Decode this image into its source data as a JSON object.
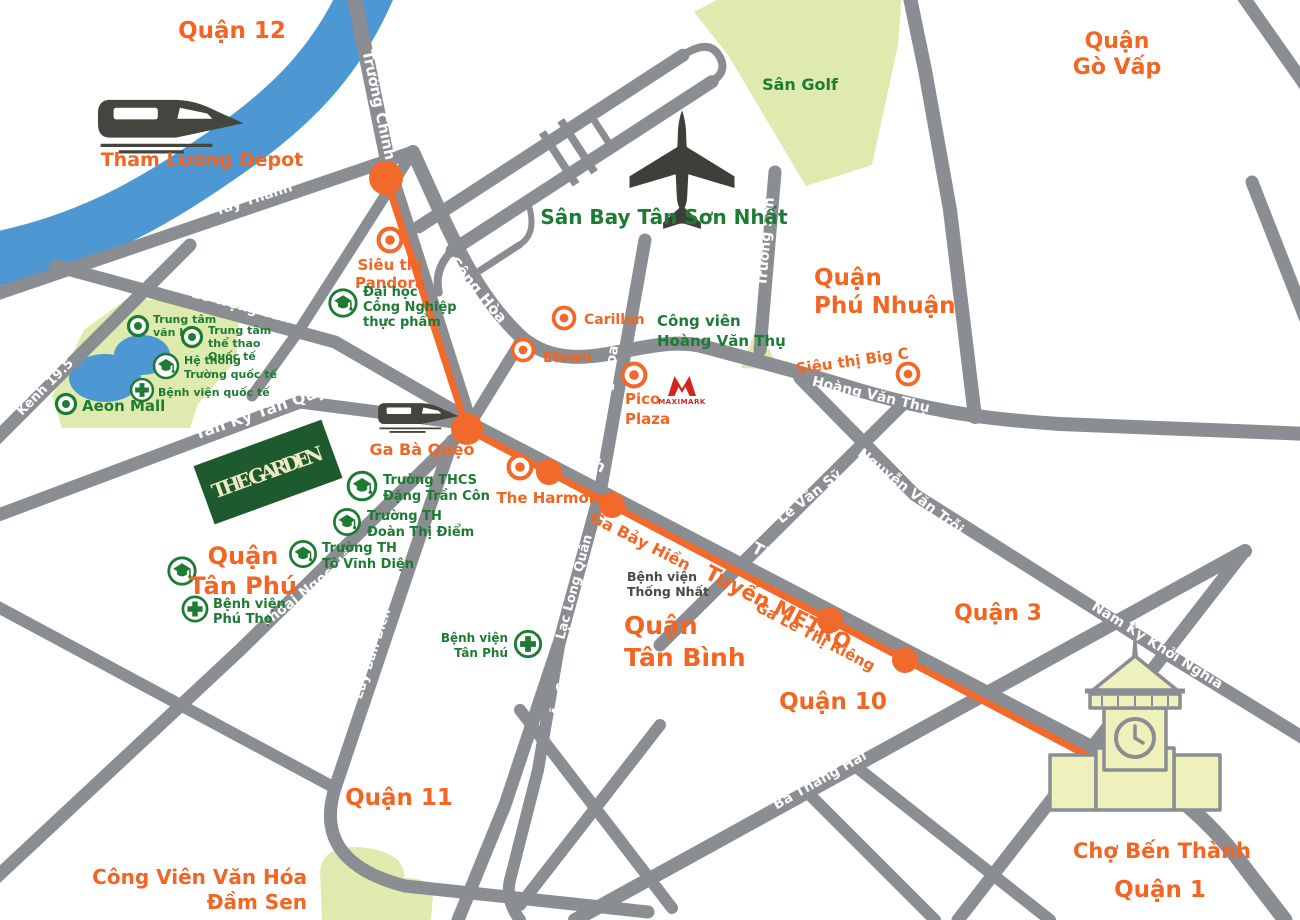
{
  "map": {
    "colors": {
      "road": "#8A8D92",
      "metro_line": "#F2692C",
      "district_text": "#F26522",
      "green_text": "#1E7B34",
      "park_fill": "#DFEAAE",
      "water": "#4D97D3",
      "building_fill": "#EFF1BC",
      "garden_sign": "#1D5B2E",
      "maximark_red": "#D6251D"
    },
    "districts": {
      "q12": "Quận 12",
      "go_vap": [
        "Quận",
        "Gò Vấp"
      ],
      "phu_nhuan": [
        "Quận",
        "Phú Nhuận"
      ],
      "tan_phu": [
        "Quận",
        "Tân Phú"
      ],
      "tan_binh": [
        "Quận",
        "Tân Bình"
      ],
      "q11": "Quận 11",
      "q10": "Quận 10",
      "q3": "Quận 3",
      "q1": "Quận 1"
    },
    "roads": {
      "truong_chinh": "Trường Chinh",
      "tay_thanh": "Tây Thanh",
      "che_lan_vien": "Chế Lan Viên",
      "cong_hoa": "Cộng Hòa",
      "le_trong_tan": "Lê Trọng Tấn",
      "kenh_19_5": "Kênh 19.5",
      "tan_ky_tan_quy": "Tân Kỳ Tân Quý",
      "thoai_ngoc_hau": "Thoại Ngọc Hầu",
      "luy_ban_bich": "Lũy Bán Bích",
      "lac_long_quan": "Lạc Long Quân",
      "au_co": "Âu Cơ",
      "hoang_hoa_tham": "Hoàng Hoa Thám",
      "truong_son": "Trường Sơn",
      "hoang_van_thu": "Hoàng Văn Thụ",
      "nguyen_van_troi": "Nguyễn Văn Trỗi",
      "le_van_sy": "Lê Văn Sỹ",
      "cach_mang_thang_tam": "Cách Mạng Tháng Tám",
      "ba_thang_hai": "Ba Tháng Hai",
      "nam_ky_khoi_nghia": "Nam Kỳ Khởi Nghĩa"
    },
    "water": {
      "kenh_tham_luong": "Kênh Tham Lương"
    },
    "parks": {
      "san_golf": "Sân Golf",
      "cong_vien_hoang_van_thu": [
        "Công viên",
        "Hoàng Văn Thụ"
      ],
      "dam_sen": [
        "Công Viên Văn Hóa",
        "Đầm Sen"
      ]
    },
    "airport": {
      "name": "Sân Bay Tân Sơn Nhất"
    },
    "metro": {
      "depot": "Tham Lương Depot",
      "line_label": "Tuyến METRO",
      "ga_ba_queo": "Ga Bà Quẹo",
      "ga_bay_hien": "Ga Bảy Hiền",
      "ga_le_thi_rieng": "Ga Lê Thị Riêng"
    },
    "landmarks": {
      "sieu_thi_pandora": [
        "Siêu thị",
        "Pandora"
      ],
      "dai_hoc_cong_nghiep": [
        "Đại học",
        "Công Nghiệp",
        "thực phẩm"
      ],
      "trung_tam_van_hoa": [
        "Trung tâm",
        "văn hóa"
      ],
      "trung_tam_the_thao": [
        "Trung tâm",
        "thể thao",
        "Quốc tế"
      ],
      "he_thong_truong_quoc_te": [
        "Hệ thống",
        "Trường quốc tế"
      ],
      "benh_vien_quoc_te": "Bệnh viện quốc tế",
      "aeon_mall": "Aeon Mall",
      "the_garden": "THE GARDEN",
      "truong_thcs_dang_tran_con": [
        "Trường THCS",
        "Đặng Trần Côn"
      ],
      "truong_th_doan_thi_diem": [
        "Trường TH",
        "Đoàn Thị Điểm"
      ],
      "truong_th_to_vinh_dien": [
        "Trường TH",
        "Tô Vĩnh Diện"
      ],
      "benh_vien_phu_tho": [
        "Bệnh viện",
        "Phú Thọ"
      ],
      "benh_vien_tan_phu": [
        "Bệnh viện",
        "Tân Phú"
      ],
      "benh_vien_thong_nhat": [
        "Bệnh viện",
        "Thống Nhất"
      ],
      "the_harmona": "The Harmona",
      "etown": "Etown",
      "carillon": "Carillon",
      "pico_plaza": [
        "Pico",
        "Plaza"
      ],
      "maximark": "MAXIMARK",
      "sieu_thi_big_c": "Siêu thị Big C",
      "cho_ben_thanh": "Chợ Bến Thành"
    },
    "icons": {
      "train": "train-icon",
      "airplane": "airplane-icon",
      "school": "graduation-cap-icon",
      "hospital": "medical-cross-icon",
      "poi_orange": "orange-circle-marker-icon",
      "poi_green": "green-circle-marker-icon",
      "station": "metro-station-dot",
      "market": "ben-thanh-market-icon"
    }
  }
}
